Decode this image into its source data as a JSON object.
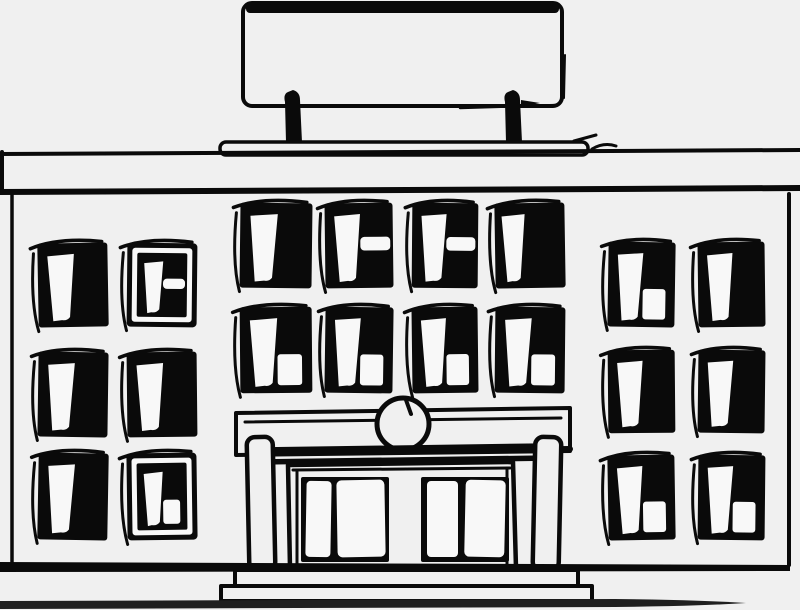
{
  "scene": {
    "description": "Hand-drawn black ink illustration of a symmetrical two-story public building with a blank rooftop signboard on two posts, a wide cornice, rows of dark windows with white panes, a columned entrance with a round clock ornament above black double doors, and front steps on a sidewalk."
  },
  "colors": {
    "background": "#f0f0f0",
    "ink": "#0a0a0a",
    "paper": "#f8f8f8",
    "ground": "#1f1f1f"
  },
  "counts": {
    "sign_posts": 2,
    "left_wing_windows": 6,
    "center_windows": 8,
    "right_wing_windows": 6,
    "entrance_columns": 2,
    "door_leaves": 4,
    "steps": 2
  },
  "windows": {
    "left_wing": [
      {
        "id": "left-r1c1",
        "x": 38,
        "y": 243,
        "w": 70,
        "h": 84,
        "variant": "pane",
        "rot": -1.0
      },
      {
        "id": "left-r1c2",
        "x": 127,
        "y": 243,
        "w": 70,
        "h": 84,
        "variant": "framed-slit",
        "rot": 0.6
      },
      {
        "id": "left-r2c1",
        "x": 38,
        "y": 352,
        "w": 70,
        "h": 85,
        "variant": "pane",
        "rot": 0.8
      },
      {
        "id": "left-r2c2",
        "x": 127,
        "y": 352,
        "w": 70,
        "h": 85,
        "variant": "pane",
        "rot": -0.6
      },
      {
        "id": "left-r3c1",
        "x": 38,
        "y": 453,
        "w": 70,
        "h": 87,
        "variant": "pane",
        "rot": 1.0
      },
      {
        "id": "left-r3c2",
        "x": 127,
        "y": 453,
        "w": 70,
        "h": 87,
        "variant": "framed-notch",
        "rot": -0.8
      }
    ],
    "center": [
      {
        "id": "center-r1c1",
        "x": 240,
        "y": 203,
        "w": 72,
        "h": 85,
        "variant": "pane",
        "rot": 0.7
      },
      {
        "id": "center-r1c2",
        "x": 325,
        "y": 203,
        "w": 68,
        "h": 85,
        "variant": "pane-slit",
        "rot": -0.7
      },
      {
        "id": "center-r1c3",
        "x": 412,
        "y": 203,
        "w": 66,
        "h": 85,
        "variant": "pane-slit",
        "rot": 0.5
      },
      {
        "id": "center-r1c4",
        "x": 495,
        "y": 203,
        "w": 70,
        "h": 85,
        "variant": "pane",
        "rot": -0.9,
        "px": 0.1,
        "pw": 0.33
      },
      {
        "id": "center-r2c1",
        "x": 240,
        "y": 307,
        "w": 72,
        "h": 86,
        "variant": "pane-notch",
        "rot": -0.5
      },
      {
        "id": "center-r2c2",
        "x": 325,
        "y": 307,
        "w": 68,
        "h": 86,
        "variant": "pane-notch",
        "rot": 0.8
      },
      {
        "id": "center-r2c3",
        "x": 412,
        "y": 307,
        "w": 66,
        "h": 86,
        "variant": "pane-notch",
        "rot": -0.7
      },
      {
        "id": "center-r2c4",
        "x": 495,
        "y": 307,
        "w": 70,
        "h": 86,
        "variant": "pane-notch",
        "rot": 0.6
      }
    ],
    "right_wing": [
      {
        "id": "right-r1c1",
        "x": 608,
        "y": 242,
        "w": 67,
        "h": 85,
        "variant": "pane-notch",
        "rot": 0.9
      },
      {
        "id": "right-r1c2",
        "x": 698,
        "y": 242,
        "w": 67,
        "h": 85,
        "variant": "pane",
        "rot": -0.7
      },
      {
        "id": "right-r2c1",
        "x": 608,
        "y": 350,
        "w": 67,
        "h": 83,
        "variant": "pane",
        "rot": -0.5
      },
      {
        "id": "right-r2c2",
        "x": 698,
        "y": 350,
        "w": 67,
        "h": 83,
        "variant": "pane",
        "rot": 0.7
      },
      {
        "id": "right-r3c1",
        "x": 608,
        "y": 455,
        "w": 67,
        "h": 85,
        "variant": "pane-notch",
        "rot": -0.9
      },
      {
        "id": "right-r3c2",
        "x": 698,
        "y": 455,
        "w": 67,
        "h": 85,
        "variant": "pane-notch",
        "rot": 0.6
      }
    ]
  }
}
